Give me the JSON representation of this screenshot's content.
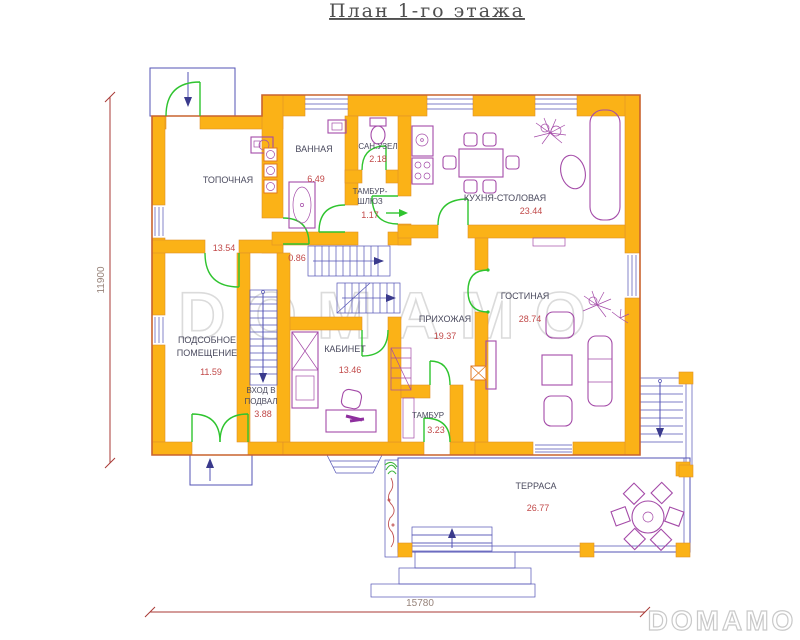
{
  "title": "План 1-го этажа",
  "brand": {
    "watermark": "DOMAMO",
    "logo": "DOMAMO"
  },
  "dimensions": {
    "vertical": "11900",
    "horizontal": "15780"
  },
  "rooms": {
    "boiler": {
      "name": "ТОПОЧНАЯ",
      "area": "13.54"
    },
    "bathroom": {
      "name": "ВАННАЯ",
      "area": "6.49"
    },
    "wc": {
      "name": "САН.УЗЕЛ",
      "area": "2.18"
    },
    "airlock": {
      "name": "ТАМБУР-ШЛЮЗ",
      "line1": "ТАМБУР-",
      "line2": "ШЛЮЗ",
      "area": "1.17"
    },
    "understairs": {
      "area": "0.86"
    },
    "kitchen": {
      "name": "КУХНЯ-СТОЛОВАЯ",
      "area": "23.44"
    },
    "utility": {
      "name": "ПОДСОБНОЕ ПОМЕЩЕНИЕ",
      "line1": "ПОДСОБНОЕ",
      "line2": "ПОМЕЩЕНИЕ",
      "area": "11.59"
    },
    "basement_entry": {
      "name": "ВХОД В ПОДВАЛ",
      "line1": "ВХОД В",
      "line2": "ПОДВАЛ",
      "area": "3.88"
    },
    "study": {
      "name": "КАБИНЕТ",
      "area": "13.46"
    },
    "hallway": {
      "name": "ПРИХОЖАЯ",
      "area": "19.37"
    },
    "living": {
      "name": "ГОСТИНАЯ",
      "area": "28.74"
    },
    "vestibule": {
      "name": "ТАМБУР",
      "area": "3.23"
    },
    "terrace": {
      "name": "ТЕРРАСА",
      "area": "26.77"
    }
  },
  "colors": {
    "wall": "#FBB217",
    "wall_edge": "#C9632F",
    "line_blue": "#5353B5",
    "door_green": "#2FC42F",
    "furniture_purple": "#A44BA8",
    "area_text": "#C14949",
    "label_text": "#4A4A5E",
    "dimension": "#A93A36",
    "watermark": "#DBDBDB"
  }
}
